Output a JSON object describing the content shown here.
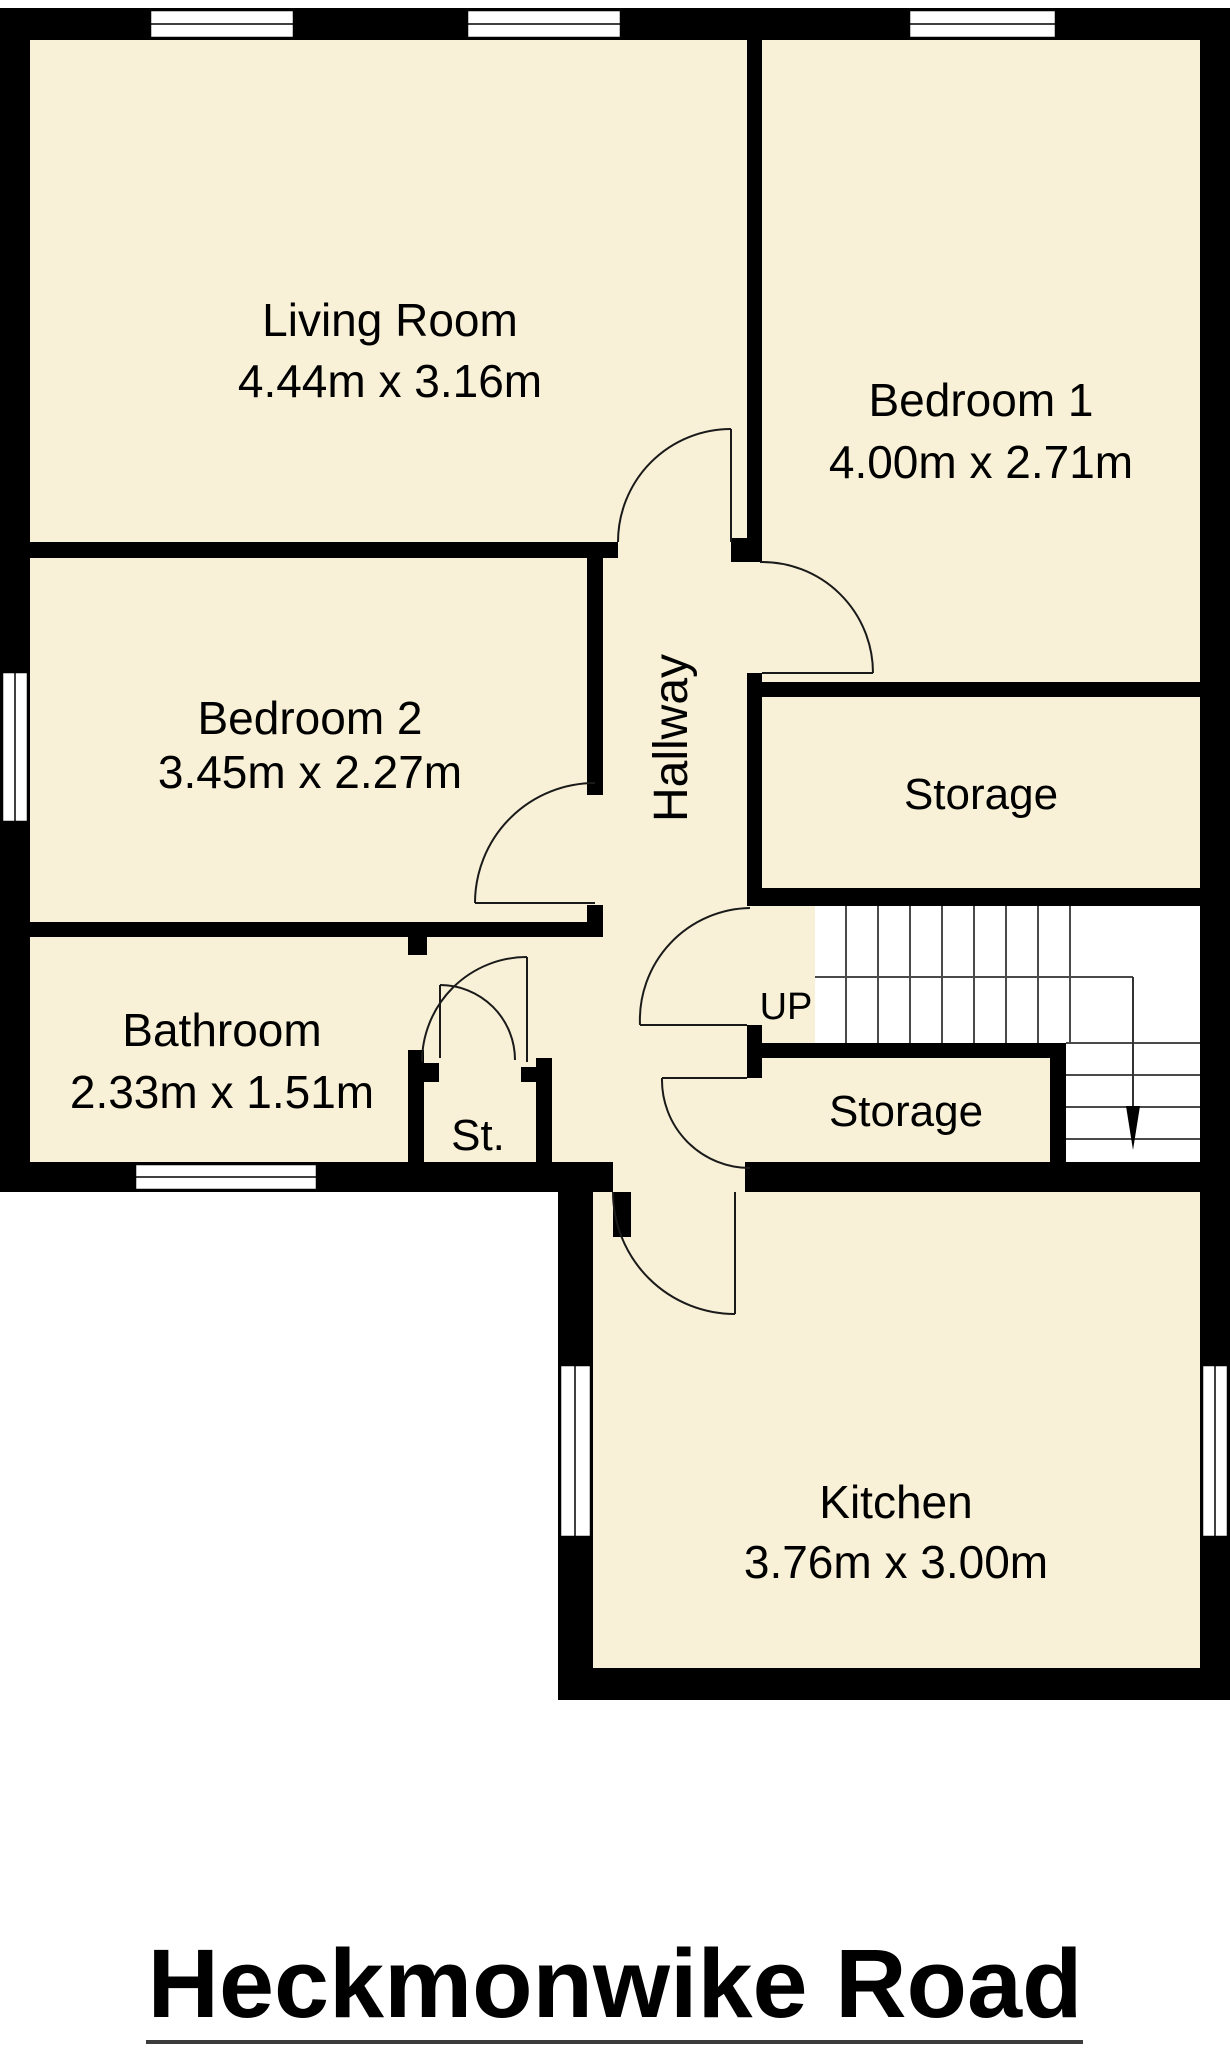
{
  "title": "Heckmonwike Road",
  "colors": {
    "floor": "#F8F1D7",
    "wall": "#000000",
    "background": "#ffffff"
  },
  "rooms": {
    "living_room": {
      "name": "Living Room",
      "dims": "4.44m x 3.16m"
    },
    "bedroom_1": {
      "name": "Bedroom 1",
      "dims": "4.00m x 2.71m"
    },
    "bedroom_2": {
      "name": "Bedroom 2",
      "dims": "3.45m x 2.27m"
    },
    "bathroom": {
      "name": "Bathroom",
      "dims": "2.33m x 1.51m"
    },
    "kitchen": {
      "name": "Kitchen",
      "dims": "3.76m x 3.00m"
    },
    "hallway": {
      "name": "Hallway"
    },
    "storage_upper": {
      "name": "Storage"
    },
    "storage_lower": {
      "name": "Storage"
    },
    "cupboard": {
      "name": "St."
    },
    "stairs": {
      "direction_label": "UP"
    }
  }
}
